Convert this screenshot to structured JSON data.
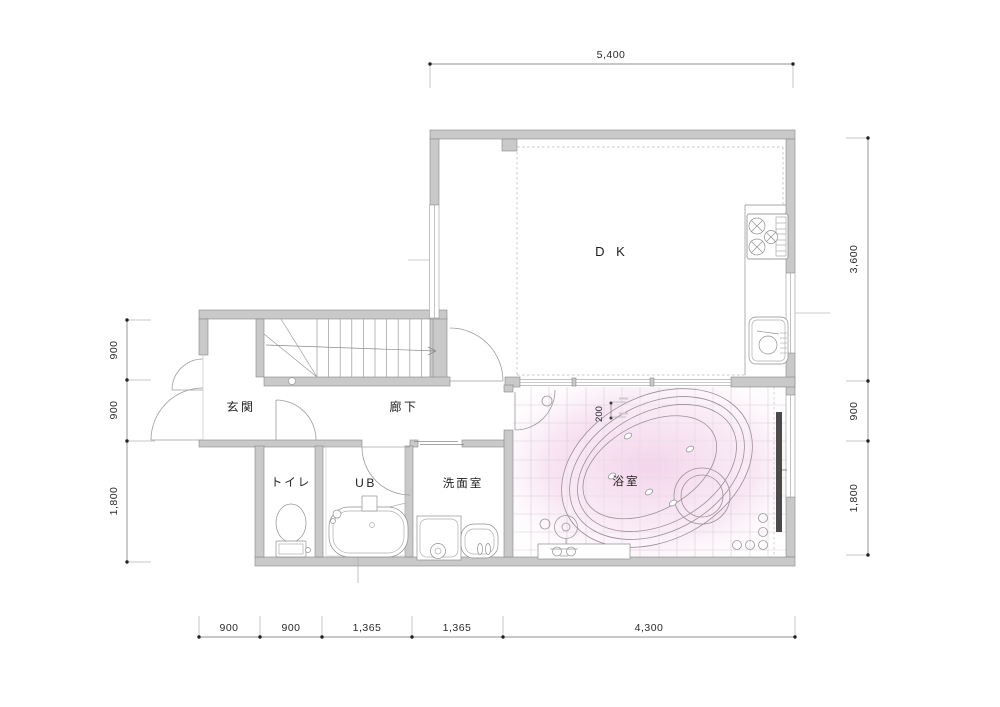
{
  "plan": {
    "type": "architectural-floor-plan",
    "highlighted_room": "bathroom"
  },
  "rooms": {
    "dk": "D K",
    "entrance": "玄関",
    "corridor": "廊下",
    "toilet": "トイレ",
    "unit_bath": "UB",
    "washroom": "洗面室",
    "bathroom": "浴室"
  },
  "dimensions": {
    "top": [
      "5,400"
    ],
    "right": [
      "3,600",
      "900",
      "1,800"
    ],
    "left": [
      "900",
      "900",
      "1,800"
    ],
    "bottom": [
      "900",
      "900",
      "1,365",
      "1,365",
      "4,300"
    ],
    "bathroom_step": "200"
  },
  "colors": {
    "wall_fill": "#c9c9c9",
    "wall_stroke": "#878787",
    "line": "#999999",
    "bath_pink": "#eec0e3",
    "tile_line": "#d9ced7",
    "background": "#ffffff"
  }
}
